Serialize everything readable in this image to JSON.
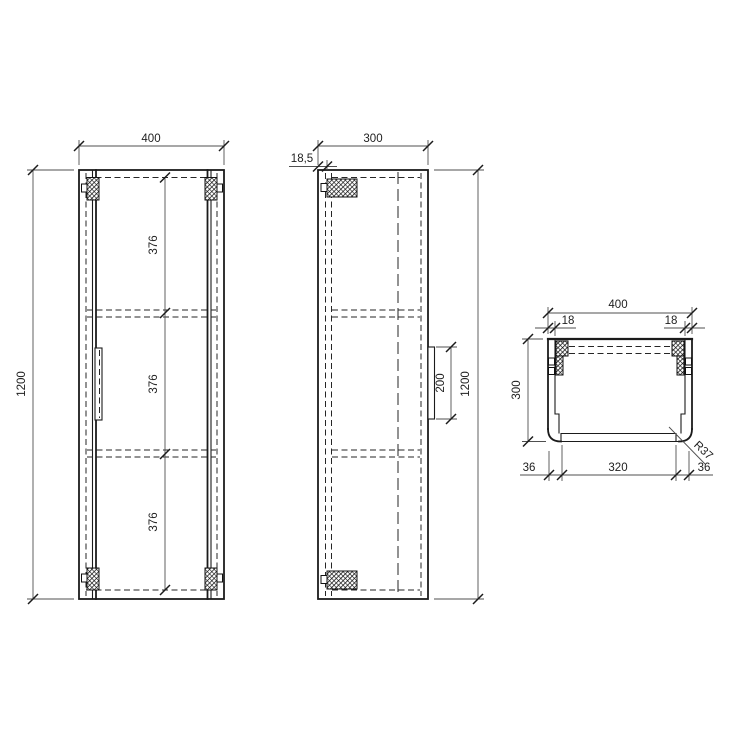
{
  "colors": {
    "line": "#1b1b1b",
    "dim_line": "#4f4f4f",
    "text": "#1e1e1e",
    "background": "#ffffff"
  },
  "views": {
    "front": {
      "width": "400",
      "height": "1200",
      "shelf_spacings": [
        "376",
        "376",
        "376"
      ]
    },
    "side": {
      "depth": "300",
      "rail_thickness": "18,5",
      "handle_length": "200",
      "height": "1200"
    },
    "top": {
      "width": "400",
      "panel_thickness_left": "18",
      "panel_thickness_right": "18",
      "depth": "300",
      "front_inset_left": "36",
      "door_width": "320",
      "front_inset_right": "36",
      "corner_radius": "R37"
    }
  }
}
